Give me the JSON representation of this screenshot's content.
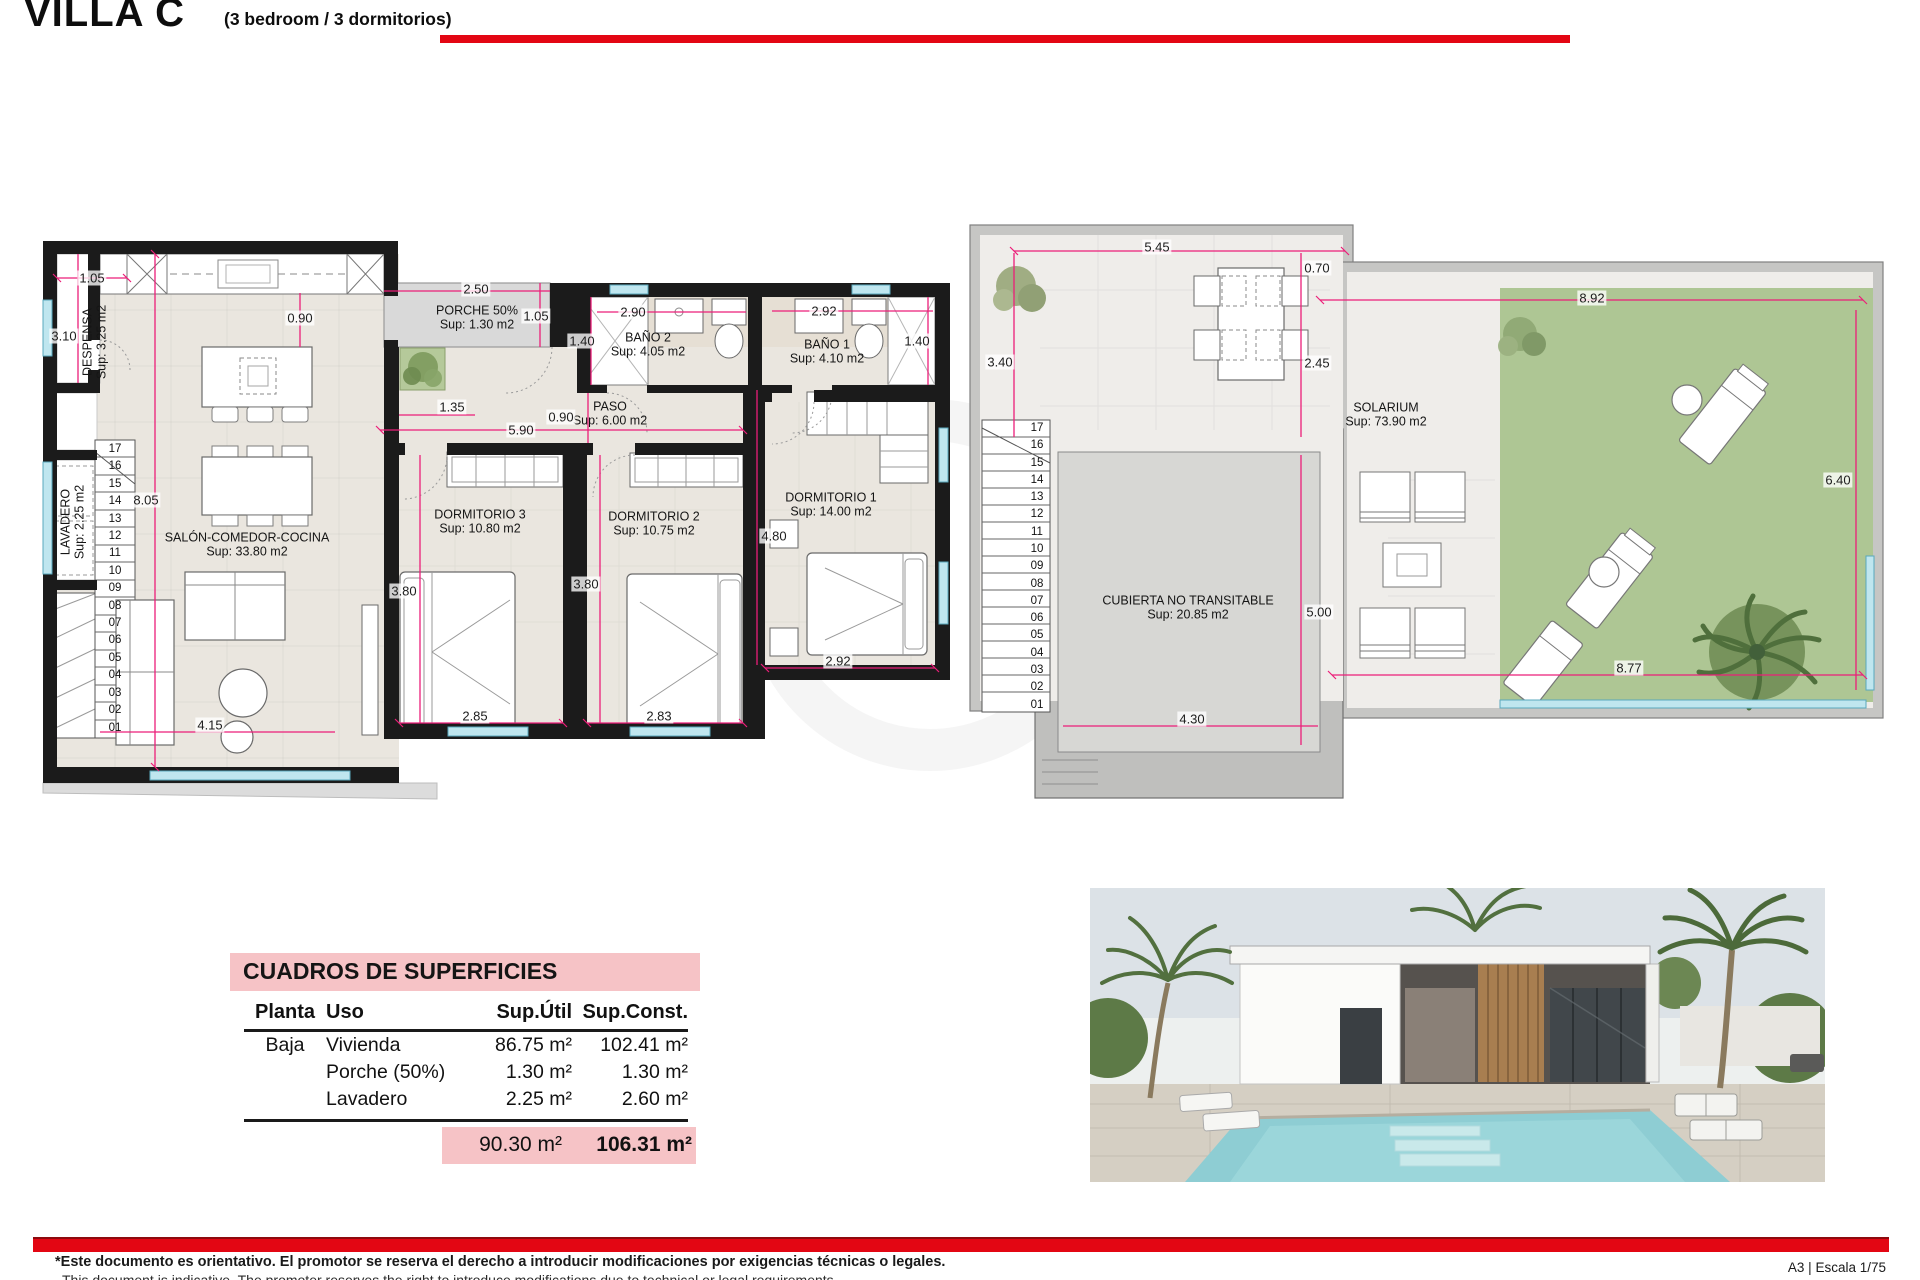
{
  "header": {
    "title": "VILLA C",
    "subtitle": "(3 bedroom / 3 dormitorios)"
  },
  "colors": {
    "accent_red": "#E30613",
    "dimension_pink": "#EC1E79",
    "table_pink": "#F6C3C6",
    "wall_black": "#1B1B1B",
    "floor_beige": "#EAE6DF",
    "porch_gray": "#D9D9D9",
    "grass_green": "#AEC694",
    "roof_gray": "#C6C6C4",
    "window_cyan": "#BFE6EF"
  },
  "ground_floor": {
    "rooms": {
      "despensa": {
        "name": "DESPENSA",
        "area": "Sup: 3.25 m2"
      },
      "salon": {
        "name": "SALÓN-COMEDOR-COCINA",
        "area": "Sup: 33.80 m2"
      },
      "lavadero": {
        "name": "LAVADERO",
        "area": "Sup: 2.25 m2"
      },
      "porche": {
        "name": "PORCHE 50%",
        "area": "Sup: 1.30 m2"
      },
      "paso": {
        "name": "PASO",
        "area": "Sup: 6.00 m2"
      },
      "bano2": {
        "name": "BAÑO 2",
        "area": "Sup: 4.05 m2"
      },
      "bano1": {
        "name": "BAÑO 1",
        "area": "Sup: 4.10 m2"
      },
      "dormitorio3": {
        "name": "DORMITORIO 3",
        "area": "Sup: 10.80 m2"
      },
      "dormitorio2": {
        "name": "DORMITORIO 2",
        "area": "Sup: 10.75 m2"
      },
      "dormitorio1": {
        "name": "DORMITORIO 1",
        "area": "Sup: 14.00 m2"
      }
    },
    "dims": [
      "1.05",
      "3.10",
      "0.90",
      "2.50",
      "1.05",
      "1.40",
      "2.90",
      "2.92",
      "1.40",
      "1.35",
      "0.90",
      "5.90",
      "8.05",
      "3.80",
      "3.80",
      "4.80",
      "2.85",
      "2.83",
      "2.92",
      "4.15"
    ],
    "stair_numbers": [
      "17",
      "16",
      "15",
      "14",
      "13",
      "12",
      "11",
      "10",
      "09",
      "08",
      "07",
      "06",
      "05",
      "04",
      "03",
      "02",
      "01"
    ]
  },
  "roof": {
    "rooms": {
      "solarium": {
        "name": "SOLARIUM",
        "area": "Sup: 73.90 m2"
      },
      "cubierta": {
        "name": "CUBIERTA NO TRANSITABLE",
        "area": "Sup: 20.85 m2"
      }
    },
    "dims": [
      "5.45",
      "0.70",
      "3.40",
      "2.45",
      "8.92",
      "6.40",
      "5.00",
      "4.30",
      "8.77"
    ],
    "stair_numbers": [
      "17",
      "16",
      "15",
      "14",
      "13",
      "12",
      "11",
      "10",
      "09",
      "08",
      "07",
      "06",
      "05",
      "04",
      "03",
      "02",
      "01"
    ]
  },
  "surface_table": {
    "title": "CUADROS DE SUPERFICIES",
    "columns": [
      "Planta",
      "Uso",
      "Sup.Útil",
      "Sup.Const."
    ],
    "rows": [
      {
        "planta": "Baja",
        "uso": "Vivienda",
        "util": "86.75 m²",
        "const": "102.41 m²"
      },
      {
        "planta": "",
        "uso": "Porche (50%)",
        "util": "1.30 m²",
        "const": "1.30 m²"
      },
      {
        "planta": "",
        "uso": "Lavadero",
        "util": "2.25 m²",
        "const": "2.60 m²"
      }
    ],
    "total_util": "90.30 m²",
    "total_const": "106.31 m²"
  },
  "footer": {
    "disclaimer_es": "*Este documento es orientativo. El promotor se reserva el derecho a introducir modificaciones por exigencias técnicas o legales.",
    "disclaimer_en": "This document is indicative. The promoter reserves the right to introduce modifications due to technical or legal requirements.",
    "sheet_info": "A3 | Escala 1/75"
  }
}
